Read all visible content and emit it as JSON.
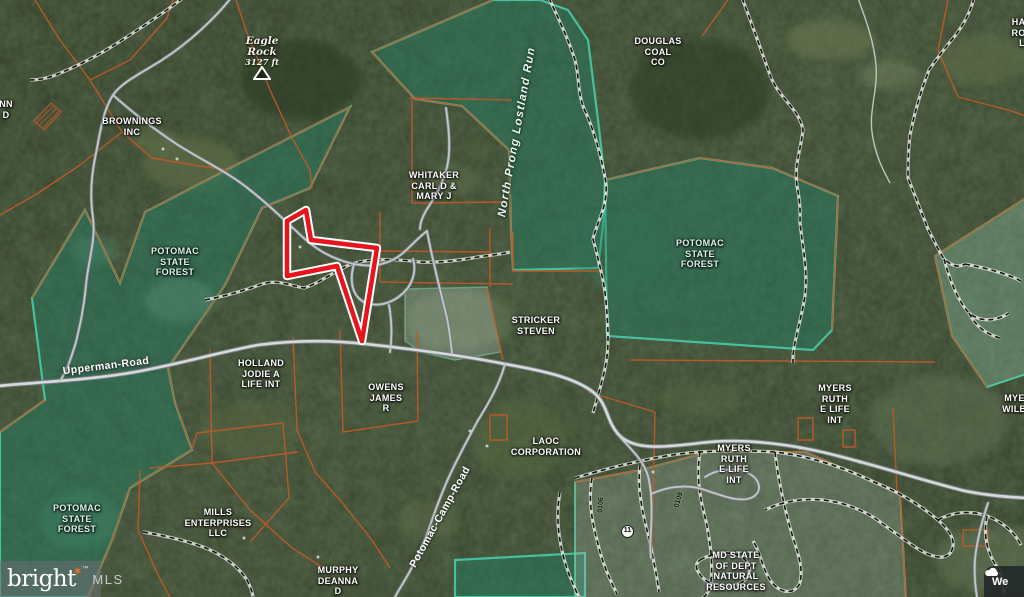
{
  "map": {
    "poi": {
      "eagle_rock": {
        "name": "Eagle Rock",
        "elevation": "3127 ft"
      }
    },
    "stream": {
      "name": "North Prong Lostland Run"
    },
    "roads": [
      {
        "name": "Upperman-Road"
      },
      {
        "name": "Potomac-Camp-Road"
      }
    ],
    "trails": {
      "marker": "11",
      "ids": [
        "0106",
        "0109"
      ]
    },
    "parcel_labels": [
      {
        "id": "brownings",
        "lines": [
          "BROWNINGS",
          "INC"
        ],
        "x": 132,
        "y": 116
      },
      {
        "id": "whitaker",
        "lines": [
          "WHITAKER",
          "CARL D &",
          "MARY J"
        ],
        "x": 434,
        "y": 170
      },
      {
        "id": "douglas-coal",
        "lines": [
          "DOUGLAS",
          "COAL",
          "CO"
        ],
        "x": 658,
        "y": 36
      },
      {
        "id": "potomac-state-forest-right",
        "lines": [
          "POTOMAC",
          "STATE",
          "FOREST"
        ],
        "x": 700,
        "y": 238,
        "tint": "forest"
      },
      {
        "id": "potomac-state-forest-left",
        "lines": [
          "POTOMAC",
          "STATE",
          "FOREST"
        ],
        "x": 175,
        "y": 246,
        "tint": "forest"
      },
      {
        "id": "potomac-state-forest-southwest",
        "lines": [
          "POTOMAC",
          "STATE",
          "FOREST"
        ],
        "x": 77,
        "y": 503,
        "tint": "forest"
      },
      {
        "id": "holland",
        "lines": [
          "HOLLAND",
          "JODIE A",
          "LIFE INT"
        ],
        "x": 261,
        "y": 358
      },
      {
        "id": "stricker",
        "lines": [
          "STRICKER",
          "STEVEN"
        ],
        "x": 536,
        "y": 315
      },
      {
        "id": "owens",
        "lines": [
          "OWENS",
          "JAMES",
          "R"
        ],
        "x": 386,
        "y": 382
      },
      {
        "id": "laoc",
        "lines": [
          "LAOC",
          "CORPORATION"
        ],
        "x": 546,
        "y": 436
      },
      {
        "id": "mills",
        "lines": [
          "MILLS",
          "ENTERPRISES",
          "LLC"
        ],
        "x": 218,
        "y": 507
      },
      {
        "id": "murphy",
        "lines": [
          "MURPHY",
          "DEANNA",
          "D"
        ],
        "x": 338,
        "y": 565
      },
      {
        "id": "myers-ruth-upper",
        "lines": [
          "MYERS",
          "RUTH",
          "E LIFE",
          "INT"
        ],
        "x": 835,
        "y": 383
      },
      {
        "id": "myers-ruth-lower",
        "lines": [
          "MYERS",
          "RUTH",
          "E LIFE",
          "INT"
        ],
        "x": 734,
        "y": 443
      },
      {
        "id": "md-state",
        "lines": [
          "MD STATE",
          "OF DEPT",
          "NATURAL",
          "RESOURCES"
        ],
        "x": 736,
        "y": 550
      },
      {
        "id": "myers-wilbur-partial",
        "lines": [
          "MYERS",
          "WILBUR"
        ],
        "x": 1021,
        "y": 393
      },
      {
        "id": "edge-partial-northeast",
        "lines": [
          "HAR",
          "ROB",
          "L"
        ],
        "x": 1022,
        "y": 17
      },
      {
        "id": "edge-partial-west",
        "lines": [
          "NN",
          "D"
        ],
        "x": 6,
        "y": 99
      }
    ],
    "attribution": {
      "brand": "bright",
      "star": "✱",
      "tm": "™",
      "org": "MLS"
    },
    "weather": {
      "label": "We"
    },
    "colors": {
      "highlight_parcel": "#e8141c",
      "parcel_line": "#c05a28",
      "state_forest_edge": "#49c2a0",
      "road_fill": "#d6d9da",
      "label_text": "#ffffff",
      "forest_label_text": "#dcf3e9"
    }
  }
}
